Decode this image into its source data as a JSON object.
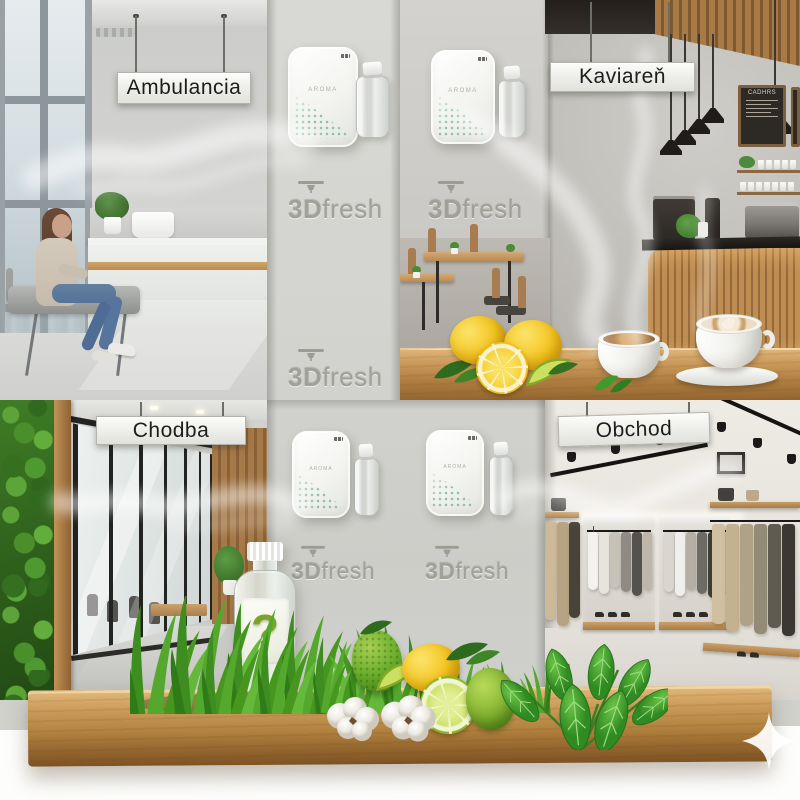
{
  "brand": {
    "prefix": "3D",
    "suffix": "fresh",
    "logo_count": 5,
    "logo_color": "#a1a19a",
    "logo_icon": "printer-head-icon"
  },
  "signs": {
    "top_left": "Ambulancia",
    "top_right": "Kaviareň",
    "bottom_left": "Chodba",
    "bottom_right": "Obchod"
  },
  "device": {
    "model_text": "AROMA",
    "count": 4,
    "body_color": "#f3f4f0",
    "dot_pattern_color": "#8fc2ab"
  },
  "cafe": {
    "menu_board_title": "CADHRS"
  },
  "mystery_bottle": {
    "symbol": "?",
    "symbol_color": "#7da32a"
  },
  "watermark": {
    "icon": "sparkle-icon"
  },
  "palette": {
    "wall_gray": "#d3d3cf",
    "wood": "#b2823f",
    "grass_green": "#4a9a2c",
    "lemon_yellow": "#f5c61f",
    "lime_green": "#8fb32e",
    "mint_green": "#3c9230",
    "cotton_white": "#f8f6f2"
  }
}
